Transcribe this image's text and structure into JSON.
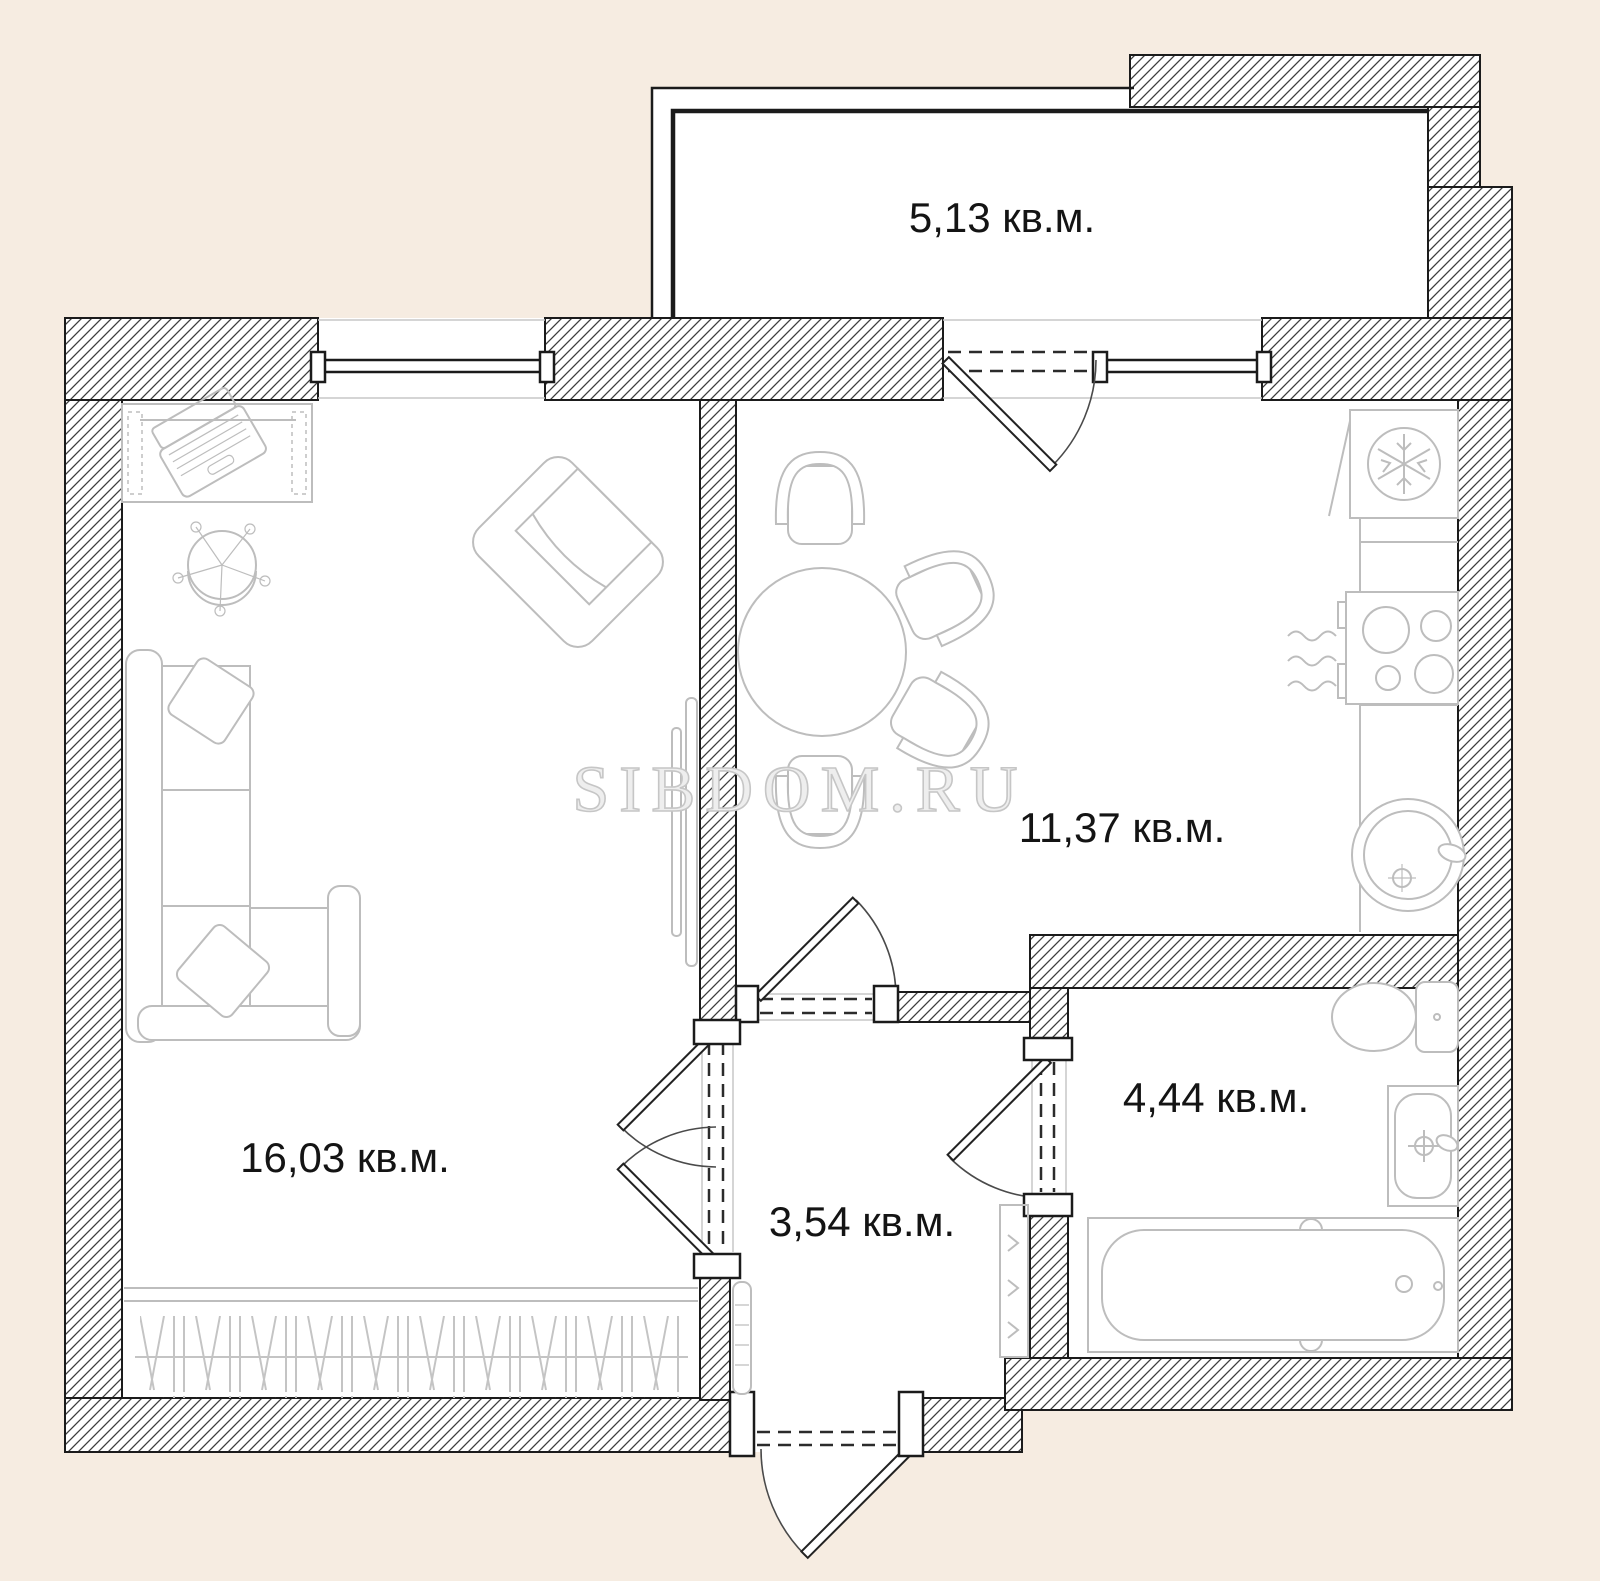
{
  "plan": {
    "watermark": "SIBDOM.RU",
    "rooms": [
      {
        "id": "balcony",
        "area_label": "5,13 кв.м."
      },
      {
        "id": "kitchen",
        "area_label": "11,37 кв.м."
      },
      {
        "id": "living-room",
        "area_label": "16,03 кв.м."
      },
      {
        "id": "hallway",
        "area_label": "3,54 кв.м."
      },
      {
        "id": "bathroom",
        "area_label": "4,44 кв.м."
      }
    ],
    "furniture_icons": [
      "desk-icon",
      "laptop-icon",
      "office-chair-icon",
      "armchair-icon",
      "corner-sofa-icon",
      "pillow-icon",
      "tv-icon",
      "wardrobe-icon",
      "dining-table-icon",
      "dining-chair-icon",
      "fridge-snowflake-icon",
      "kitchen-counter-icon",
      "stove-icon",
      "radiator-icon",
      "kitchen-sink-icon",
      "toilet-icon",
      "washbasin-icon",
      "bathtub-icon",
      "riser-icon",
      "hall-cabinet-icon",
      "door-icon",
      "window-icon"
    ],
    "colors": {
      "background": "#f6ece1",
      "floor": "#ffffff",
      "wall_line": "#1b1b1b",
      "hatch_line": "#3d3d3d",
      "furniture_line": "#bdbdbd",
      "label_text": "#141414",
      "watermark": "#c6c6c6"
    }
  }
}
